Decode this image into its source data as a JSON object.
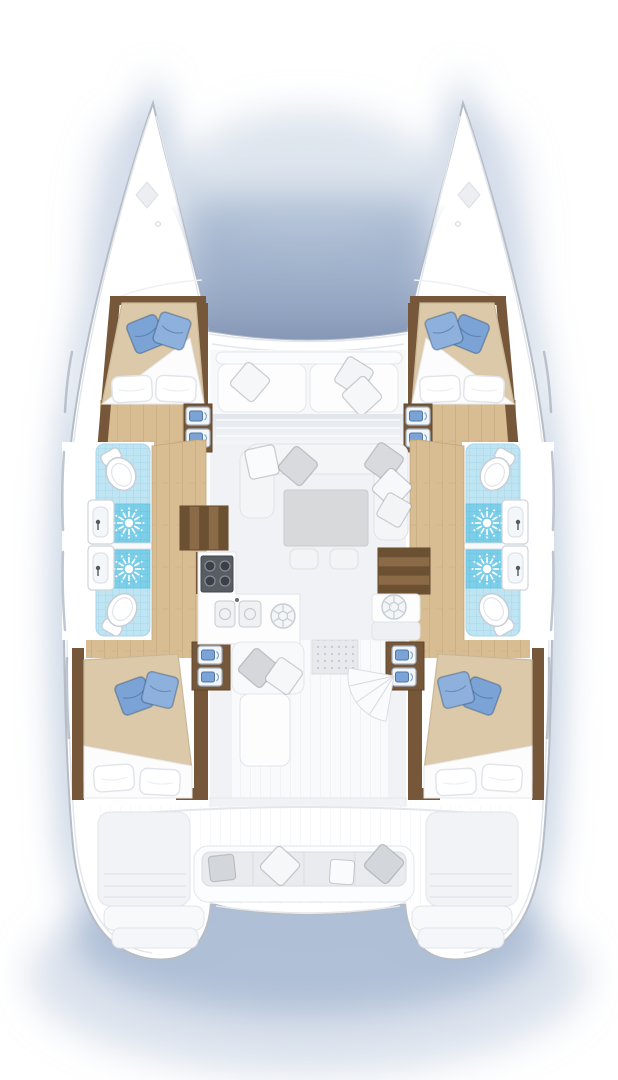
{
  "scene": {
    "subject": "catamaran-deck-plan",
    "view": "top-down, bow up",
    "hull_count": 2,
    "visible_text": ""
  },
  "colors": {
    "hull_white": "#ffffff",
    "hull_outline": "#b6bdc7",
    "gunwale": "#e3e7ec",
    "deck_shade": "#f1f3f6",
    "shadow_blue": "#a9bcd4",
    "tramp_deep": "#8ca3c2",
    "wood_dark": "#76573a",
    "wood_mid": "#8a6a47",
    "wood_deep": "#604729",
    "wood_light": "#d8bd92",
    "wood_seam": "#c2a377",
    "tile_light": "#bfe4f2",
    "tile_grid": "#9fd4ea",
    "tile_shower": "#7dcfe9",
    "tile_shower_grid": "#5fc0de",
    "pillow_blue": "#7ca3d6",
    "pillow_blue_light": "#8db1dc",
    "pillow_blue_dark": "#4f78a8",
    "duvet_tan": "#dbc9a9",
    "duvet_edge": "#c9b896",
    "linen": "#fcfcfd",
    "linen_edge": "#e1e5ea",
    "sofa_gray": "#e9ebee",
    "sofa_edge": "#d9dce0",
    "table_gray": "#d7d9db",
    "stove_dark": "#575d63",
    "fixture": "#c6cdd6",
    "deck_line": "#e8ebf0"
  },
  "inventory": {
    "forward_cabins": 2,
    "aft_cabins": 2,
    "double_beds": 4,
    "blue_pillows_per_bed": 2,
    "white_pillows_per_bed": 2,
    "shower_rooms": 4,
    "toilets": 4,
    "washbasins": 4,
    "shower_sunburst_symbols": 4,
    "step_cabinet_units": 4,
    "galley_stove_burners": 4,
    "galley_sinks": 2,
    "deck_hatches_round": 2,
    "bow_deck_hatches": 2,
    "salon_tables": 1,
    "ottomans": 2,
    "hull_staircases": 2,
    "cockpit_bench_pillows": 4,
    "trampoline": 1,
    "swim_step_tiers_per_hull": 2
  }
}
